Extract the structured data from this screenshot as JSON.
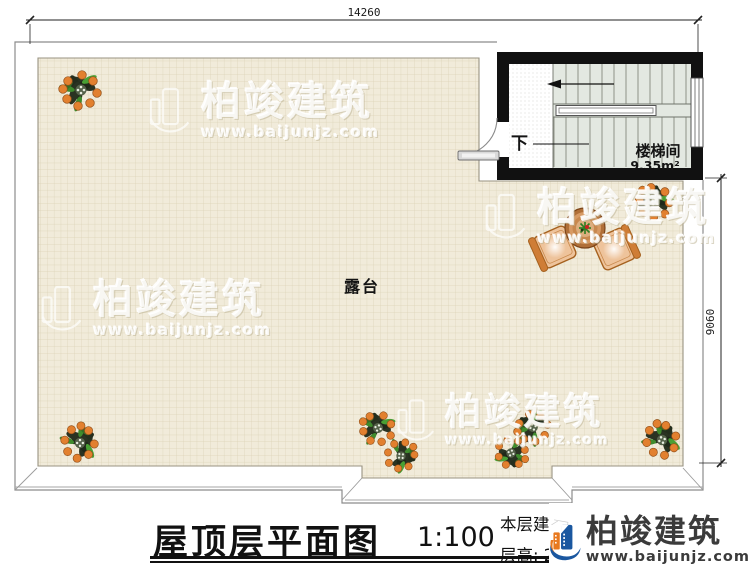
{
  "plan": {
    "top_dimension": "14260",
    "right_dimension": "9060",
    "terrace_label": "露台",
    "stair_room_label": "楼梯间",
    "stair_room_area": "9.35m²",
    "stair_down_label": "下"
  },
  "watermark": {
    "brand": "柏竣建筑",
    "url": "www.baijunjz.com"
  },
  "title_block": {
    "title": "屋顶层平面图",
    "scale": "1:100",
    "area_text": "本层建筑面积: 12.62m²",
    "floor_height_text": "层高: 2.7m"
  },
  "logo": {
    "brand": "柏竣建筑",
    "url": "www.baijunjz.com"
  },
  "colors": {
    "logo_blue": "#1a57a0",
    "logo_orange": "#e8791f",
    "wall_black": "#111111",
    "tile_bg": "#f1ebda",
    "stair_fill": "#e3e8e1"
  }
}
